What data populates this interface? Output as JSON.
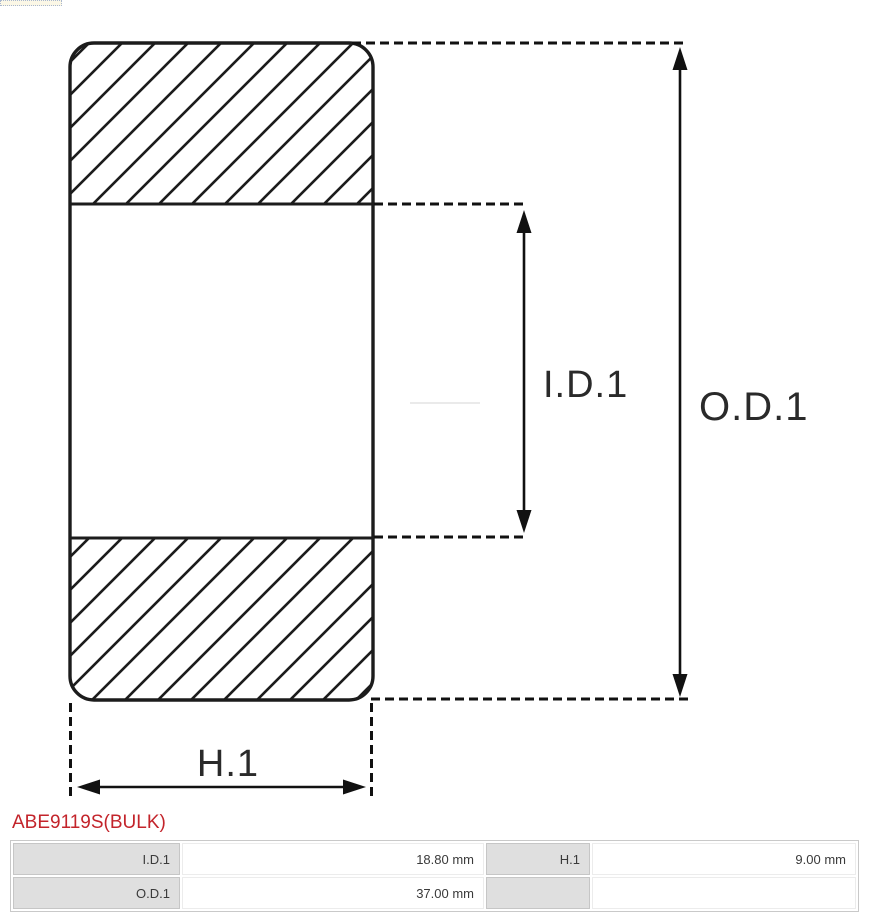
{
  "part_number": "ABE9119S(BULK)",
  "diagram": {
    "labels": {
      "inner_diameter": "I.D.1",
      "outer_diameter": "O.D.1",
      "height": "H.1"
    }
  },
  "table": {
    "rows": [
      {
        "cells": [
          {
            "label": "I.D.1",
            "value": "18.80 mm"
          },
          {
            "label": "H.1",
            "value": "9.00 mm"
          }
        ]
      },
      {
        "cells": [
          {
            "label": "O.D.1",
            "value": "37.00 mm"
          },
          {
            "label": "",
            "value": ""
          }
        ]
      }
    ]
  },
  "colors": {
    "accent_red": "#c3242b",
    "ink": "#1c1c1c",
    "table_label_bg": "#dfdfdf",
    "table_border": "#c9c9c9"
  }
}
